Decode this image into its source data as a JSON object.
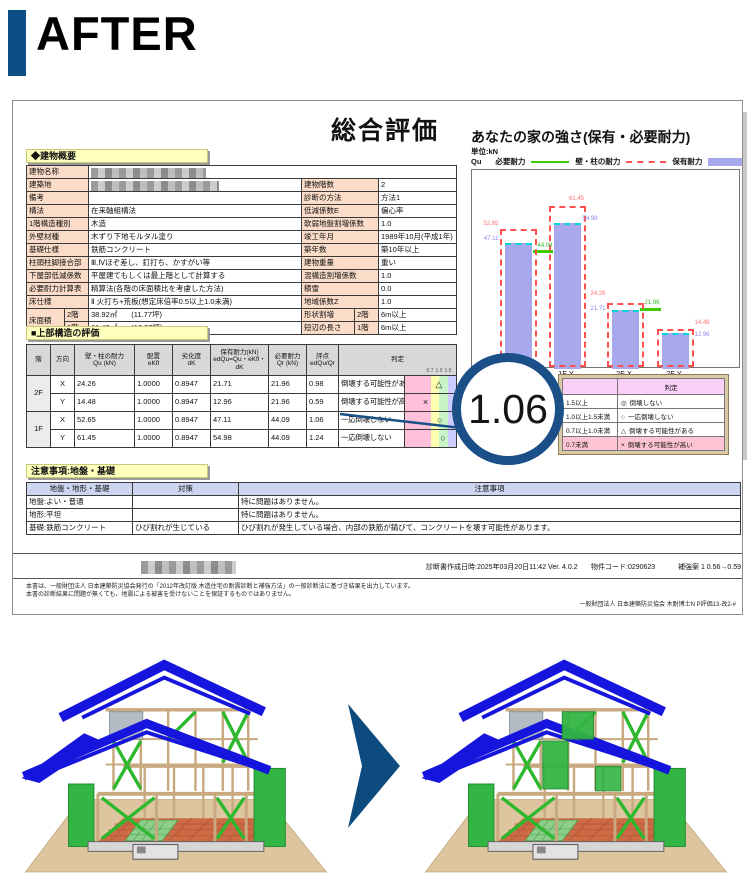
{
  "page": {
    "label": "AFTER"
  },
  "report": {
    "title": "総合評価",
    "building_overview": {
      "section_title": "◆建物概要",
      "rows": [
        {
          "label": "建物名称",
          "value": "",
          "redacted": true,
          "full": true
        },
        {
          "label": "建築地",
          "value": "",
          "redacted": true,
          "rlabel": "建物階数",
          "rvalue": "2"
        },
        {
          "label": "備考",
          "value": "",
          "rlabel": "診断の方法",
          "rvalue": "方法1"
        },
        {
          "label": "構法",
          "value": "在来軸組構法",
          "rlabel": "低減係数E",
          "rvalue": "偏心率"
        },
        {
          "label": "1階構造種別",
          "value": "木造",
          "rlabel": "軟弱地盤割増係数",
          "rvalue": "1.0"
        },
        {
          "label": "外壁材種",
          "value": "木ずり下地モルタル塗り",
          "rlabel": "竣工年月",
          "rvalue": "1989年10月(平成1年)"
        },
        {
          "label": "基礎仕様",
          "value": "鉄筋コンクリート",
          "rlabel": "築年数",
          "rvalue": "築10年以上"
        },
        {
          "label": "柱頭柱脚接合部",
          "value": "Ⅲ,Ⅳほぞ差し、釘打ち、かすがい等",
          "rlabel": "建物重量",
          "rvalue": "重い"
        },
        {
          "label": "下屋部低減係数",
          "value": "平屋建てもしくは最上階として計算する",
          "rlabel": "混構造割増係数",
          "rvalue": "1.0"
        },
        {
          "label": "必要耐力計算表",
          "value": "精算法(各階の床面積比を考慮した方法)",
          "rlabel": "積雪",
          "rvalue": "0.0"
        },
        {
          "label": "床仕様",
          "value": "Ⅱ 火打ち+荒板(想定床倍率0.5以上1.0未満)",
          "rlabel": "地域係数Z",
          "rvalue": "1.0"
        },
        {
          "label": "床面積",
          "sub": "2階",
          "value": "38.92㎡",
          "value2": "(11.77坪)",
          "rlabel": "形状割増",
          "rsub": "2階",
          "rvalue": "6m以上"
        },
        {
          "label": "",
          "sub": "1階",
          "value": "61.42㎡",
          "value2": "(18.57坪)",
          "rlabel": "短辺の長さ",
          "rsub": "1階",
          "rvalue": "6m以上"
        }
      ]
    },
    "upper_structure": {
      "section_title": "■上部構造の評価",
      "headers": [
        "階",
        "方向",
        "壁・柱の耐力\nQu (kN)",
        "配置\neKfl",
        "劣化度\ndK",
        "保有耐力(kN)\nedQu=Qu・eKfl・dK",
        "必要耐力\nQr (kN)",
        "評点\nedQu/Qr",
        "判定"
      ],
      "scale_ticks": [
        "0.7",
        "1.0",
        "1.5"
      ],
      "rows": [
        {
          "floor": "2F",
          "dir": "X",
          "qu": "24.26",
          "ekfl": "1.0000",
          "dk": "0.8947",
          "edqu": "21.71",
          "qr": "21.96",
          "score": "0.98",
          "score_num": 0.98,
          "judgment": "倒壊する可能性がある",
          "mark": "△"
        },
        {
          "floor": "",
          "dir": "Y",
          "qu": "14.48",
          "ekfl": "1.0000",
          "dk": "0.8947",
          "edqu": "12.96",
          "qr": "21.96",
          "score": "0.59",
          "score_num": 0.59,
          "judgment": "倒壊する可能性が高い",
          "mark": "×"
        },
        {
          "floor": "1F",
          "dir": "X",
          "qu": "52.65",
          "ekfl": "1.0000",
          "dk": "0.8947",
          "edqu": "47.11",
          "qr": "44.09",
          "score": "1.06",
          "score_num": 1.06,
          "judgment": "一応倒壊しない",
          "mark": "○"
        },
        {
          "floor": "",
          "dir": "Y",
          "qu": "61.45",
          "ekfl": "1.0000",
          "dk": "0.8947",
          "edqu": "54.98",
          "qr": "44.09",
          "score": "1.24",
          "score_num": 1.24,
          "judgment": "一応倒壊しない",
          "mark": "○"
        }
      ]
    },
    "judgment_legend": {
      "corner": "",
      "header": "判定",
      "rows": [
        {
          "range": "1.5以上",
          "mark": "◎",
          "text": "倒壊しない",
          "highlight": false
        },
        {
          "range": "1.0以上1.5未満",
          "mark": "○",
          "text": "一応倒壊しない",
          "highlight": false
        },
        {
          "range": "0.7以上1.0未満",
          "mark": "△",
          "text": "倒壊する可能性がある",
          "highlight": false
        },
        {
          "range": "0.7未満",
          "mark": "×",
          "text": "倒壊する可能性が高い",
          "highlight": true
        }
      ]
    },
    "notes": {
      "section_title": "注意事項:地盤・基礎",
      "headers": [
        "地盤・地形・基礎",
        "対策",
        "注意事項"
      ],
      "rows": [
        {
          "c1": "地盤:よい・普通",
          "c2": "",
          "c3": "特に問題はありません。"
        },
        {
          "c1": "地形:平坦",
          "c2": "",
          "c3": "特に問題はありません。"
        },
        {
          "c1": "基礎:鉄筋コンクリート",
          "c2": "ひび割れが生じている",
          "c3": "ひび割れが発生している場合、内部の鉄筋が錆びて、コンクリートを壊す可能性があります。"
        }
      ]
    },
    "footer": {
      "created": "診断書作成日時:2025年03月20日11:42  Ver.  4.0.2",
      "property_code": "物件コード:0290623",
      "plan": "補強案 1  0.56→0.59",
      "disclaimer1": "本書は、一般財団法人 日本建築防災協会発行の「2012年改訂版 木造住宅の耐震診断と補強方法」の一般診断法に基づき結果を出力しています。",
      "disclaimer2": "本書の診断結果に問題が無くても、地震による被害を受けないことを保証するものではありません。",
      "credit": "一般財団法人 日本建築防災協会  木耐博士N  P評価13-改2-#"
    }
  },
  "score_badge": {
    "value": "1.06"
  },
  "chart_data": {
    "type": "bar",
    "title": "あなたの家の強さ(保有・必要耐力)",
    "unit": "単位:kN",
    "axis_symbol": "Qu",
    "categories": [
      "1F X",
      "1F Y",
      "2F X",
      "2F Y"
    ],
    "series": [
      {
        "name": "必要耐力",
        "style": "green-line",
        "color": "#3ecc00",
        "values": [
          44.09,
          44.09,
          21.96,
          21.96
        ]
      },
      {
        "name": "壁・柱の耐力",
        "style": "red-dashed-outline",
        "color": "#ff5050",
        "values": [
          52.65,
          61.45,
          24.26,
          14.48
        ]
      },
      {
        "name": "保有耐力",
        "style": "bar",
        "color": "#a8a8ec",
        "values": [
          47.11,
          54.98,
          21.71,
          12.96
        ]
      }
    ],
    "ylim": [
      0,
      75
    ],
    "legend_position": "top",
    "grid": false
  },
  "colors": {
    "accent_blue": "#0d4e86",
    "band_pink": "#ffc0dc",
    "band_yellow": "#ffffb0",
    "band_green": "#c8f5c8",
    "band_lavender": "#ccccff",
    "wall_label": "#ff7070",
    "bar_label": "#8888ee",
    "need_label": "#33bb33"
  }
}
